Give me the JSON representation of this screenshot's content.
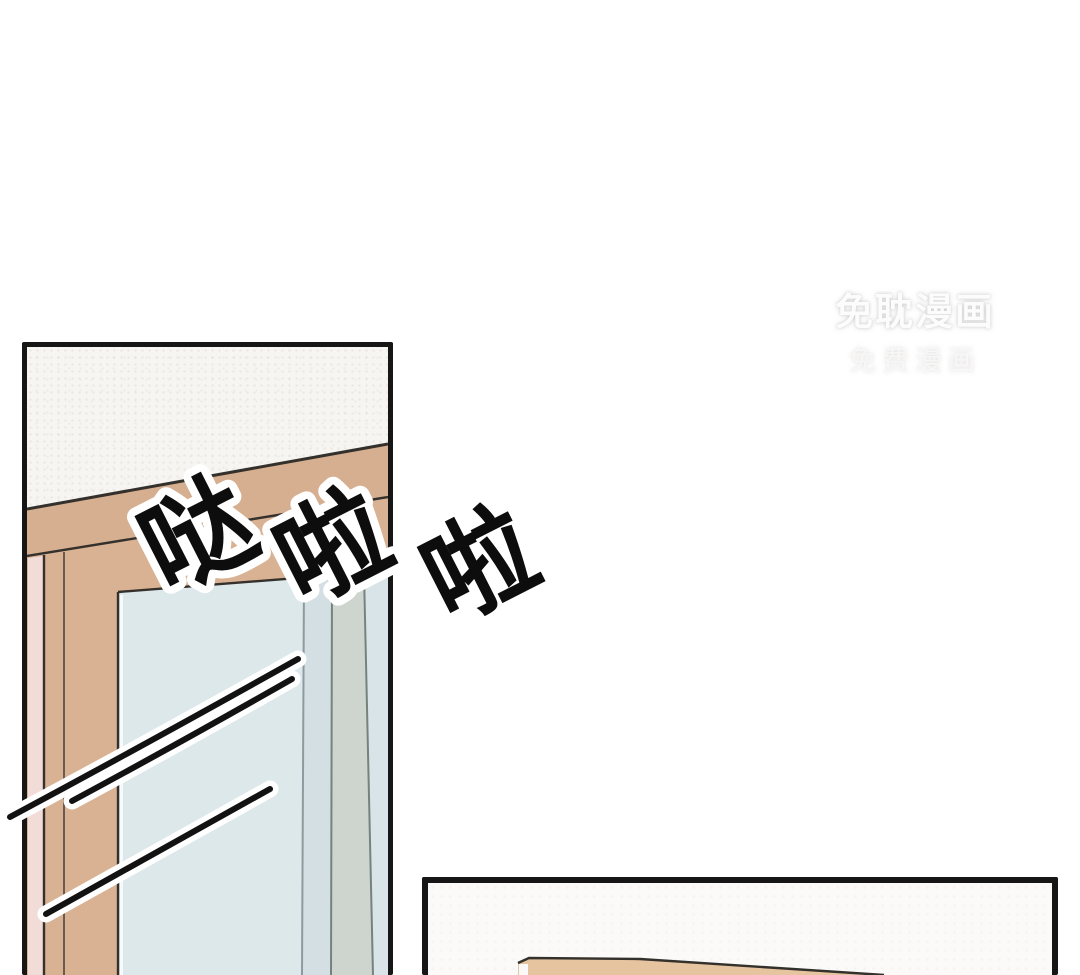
{
  "watermark": {
    "line1": "免耽漫画",
    "line2": "免费漫画"
  },
  "sfx": {
    "full": "哒啦啦",
    "chars": [
      "哒",
      "啦",
      "啦"
    ]
  },
  "colors": {
    "page_bg": "#ffffff",
    "panel_border": "#161616",
    "wall_white": "#f7f5f2",
    "frame_tan_top": "#d6ae90",
    "frame_tan": "#d9b294",
    "wall_pink": "#f2dcd7",
    "glass_blue": "#dde8ea",
    "glass_shade": "#d4dfe3",
    "sash_gray": "#cdd5ce",
    "glass_sliver": "#d8e4e7",
    "outline_dark": "#34302b",
    "sfx_fill": "#0d0d0d",
    "sfx_outline": "#ffffff",
    "desk_tan": "#e6c49f",
    "panel2_bg": "#fbfaf8"
  }
}
